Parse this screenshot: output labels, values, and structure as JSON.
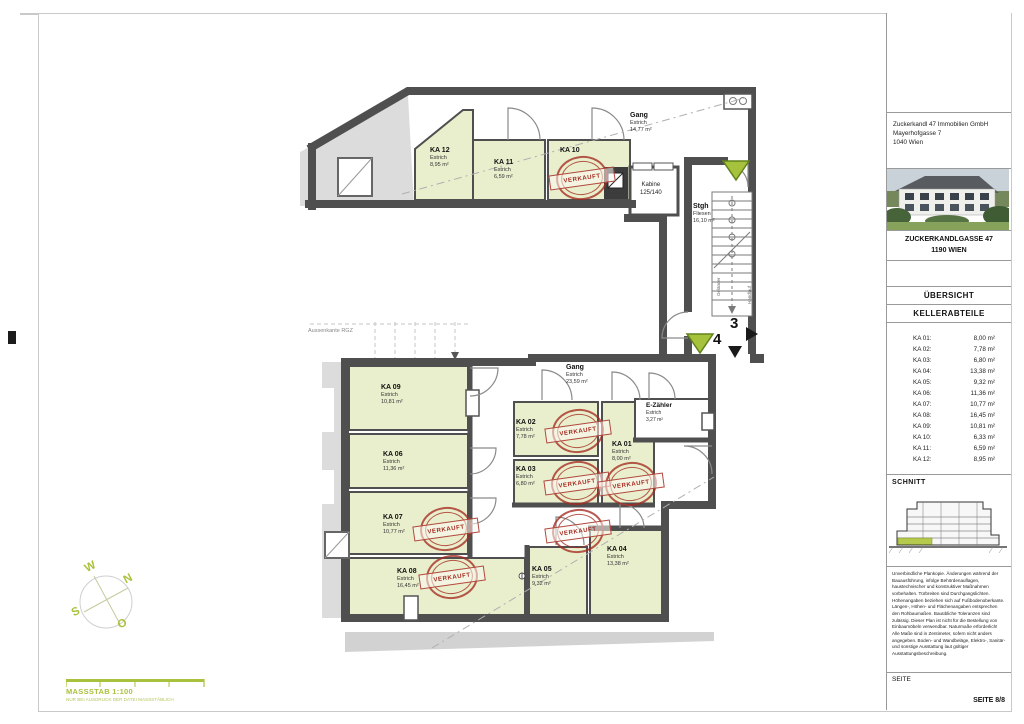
{
  "sheet": {
    "scale_label": "MASSSTAB 1:100",
    "scale_note": "NUR BEI AUSDRUCK DER DATEI MASSSTÄBLICH"
  },
  "compass": {
    "n": "N",
    "e": "O",
    "s": "S",
    "w": "W"
  },
  "stamp_text": "VERKAUFT",
  "plan": {
    "annotations": {
      "aussenkante": "Aussenkante RGZ",
      "gelaender": "Geländer",
      "handlauf": "Handlauf",
      "section_3": "3",
      "section_4": "4"
    },
    "rooms": {
      "ka01": {
        "name": "KA 01",
        "floor": "Estrich",
        "area": "8,00 m²"
      },
      "ka02": {
        "name": "KA 02",
        "floor": "Estrich",
        "area": "7,78 m²"
      },
      "ka03": {
        "name": "KA 03",
        "floor": "Estrich",
        "area": "6,80 m²"
      },
      "ka04": {
        "name": "KA 04",
        "floor": "Estrich",
        "area": "13,38 m²"
      },
      "ka05": {
        "name": "KA 05",
        "floor": "Estrich",
        "area": "9,32 m²"
      },
      "ka06": {
        "name": "KA 06",
        "floor": "Estrich",
        "area": "11,36 m²"
      },
      "ka07": {
        "name": "KA 07",
        "floor": "Estrich",
        "area": "10,77 m²"
      },
      "ka08": {
        "name": "KA 08",
        "floor": "Estrich",
        "area": "16,45 m²"
      },
      "ka09": {
        "name": "KA 09",
        "floor": "Estrich",
        "area": "10,81 m²"
      },
      "ka10": {
        "name": "KA 10",
        "floor": "Estrich",
        "area": "6,33 m²"
      },
      "ka11": {
        "name": "KA 11",
        "floor": "Estrich",
        "area": "6,59 m²"
      },
      "ka12": {
        "name": "KA 12",
        "floor": "Estrich",
        "area": "8,95 m²"
      },
      "gang_og": {
        "name": "Gang",
        "floor": "Estrich",
        "area": "14,77 m²"
      },
      "gang_ug": {
        "name": "Gang",
        "floor": "Estrich",
        "area": "23,59 m²"
      },
      "stgh": {
        "name": "Stgh",
        "floor": "Fliesen",
        "area": "16,10 m²"
      },
      "kabine": {
        "name": "Kabine",
        "size": "125/140"
      },
      "ezaehler": {
        "name": "E-Zähler",
        "floor": "Estrich",
        "area": "3,27 m²"
      }
    }
  },
  "titleblock": {
    "company": [
      "Zuckerkandl 47 Immobilien GmbH",
      "Mayerhofgasse 7",
      "1040 Wien"
    ],
    "project_name": "ZUCKERKANDLGASSE 47",
    "project_city": "1190 WIEN",
    "doc_title": "ÜBERSICHT",
    "doc_subtitle": "KELLERABTEILE",
    "ka_list": [
      {
        "label": "KA 01:",
        "area": "8,00 m²"
      },
      {
        "label": "KA 02:",
        "area": "7,78 m²"
      },
      {
        "label": "KA 03:",
        "area": "6,80 m²"
      },
      {
        "label": "KA 04:",
        "area": "13,38 m²"
      },
      {
        "label": "KA 05:",
        "area": "9,32 m²"
      },
      {
        "label": "KA 06:",
        "area": "11,36 m²"
      },
      {
        "label": "KA 07:",
        "area": "10,77 m²"
      },
      {
        "label": "KA 08:",
        "area": "16,45 m²"
      },
      {
        "label": "KA 09:",
        "area": "10,81 m²"
      },
      {
        "label": "KA 10:",
        "area": "6,33 m²"
      },
      {
        "label": "KA 11:",
        "area": "6,59 m²"
      },
      {
        "label": "KA 12:",
        "area": "8,95 m²"
      }
    ],
    "schnitt_label": "SCHNITT",
    "disclaimer": "Unverbindliche Plankopie. Änderungen während der Bauausführung, infolge Behördenauflagen, haustechnischer und konstruktiver Maßnahmen vorbehalten. Türbreiten sind Durchgangslichten. Höhenangaben beziehen sich auf Fußbodenoberkante. Längen-, Höhen- und Flächenangaben entsprechen den Rohbaumaßen. Bauübliche Toleranzen sind zulässig. Dieser Plan ist nicht für die Bestellung von Einbaumöbeln verwendbar. Naturmaße erforderlich! Alle Maße sind in Zentimeter, sofern nicht anders angegeben. Boden- und Wandbeläge, Elektro-, Sanitär- und sonstige Ausstattung laut gültiger Ausstattungsbeschreibung.",
    "footer_label": "SEITE",
    "footer_page": "SEITE 8/8"
  }
}
